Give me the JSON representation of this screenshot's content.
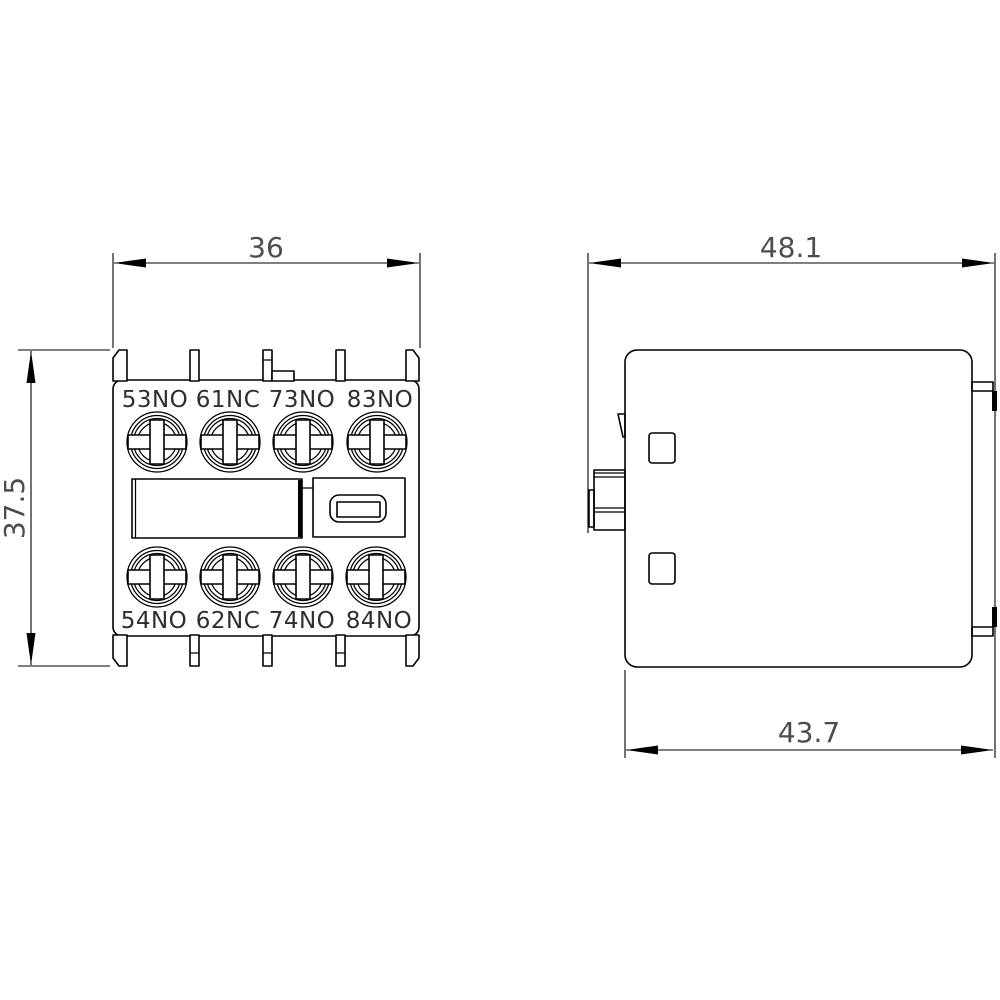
{
  "drawing": {
    "kind": "technical-dimension-drawing",
    "views": [
      "front-view",
      "side-view"
    ],
    "front_view": {
      "dim_width": "36",
      "dim_height": "37.5",
      "top_terminals": [
        "53NO",
        "61NC",
        "73NO",
        "83NO"
      ],
      "bottom_terminals": [
        "54NO",
        "62NC",
        "74NO",
        "84NO"
      ]
    },
    "side_view": {
      "dim_overall_depth": "48.1",
      "dim_body_depth": "43.7"
    },
    "colors": {
      "line": "#000000",
      "dimension_text": "#4d4d4d",
      "terminal_text": "#2e2e2e",
      "background": "#ffffff"
    }
  }
}
